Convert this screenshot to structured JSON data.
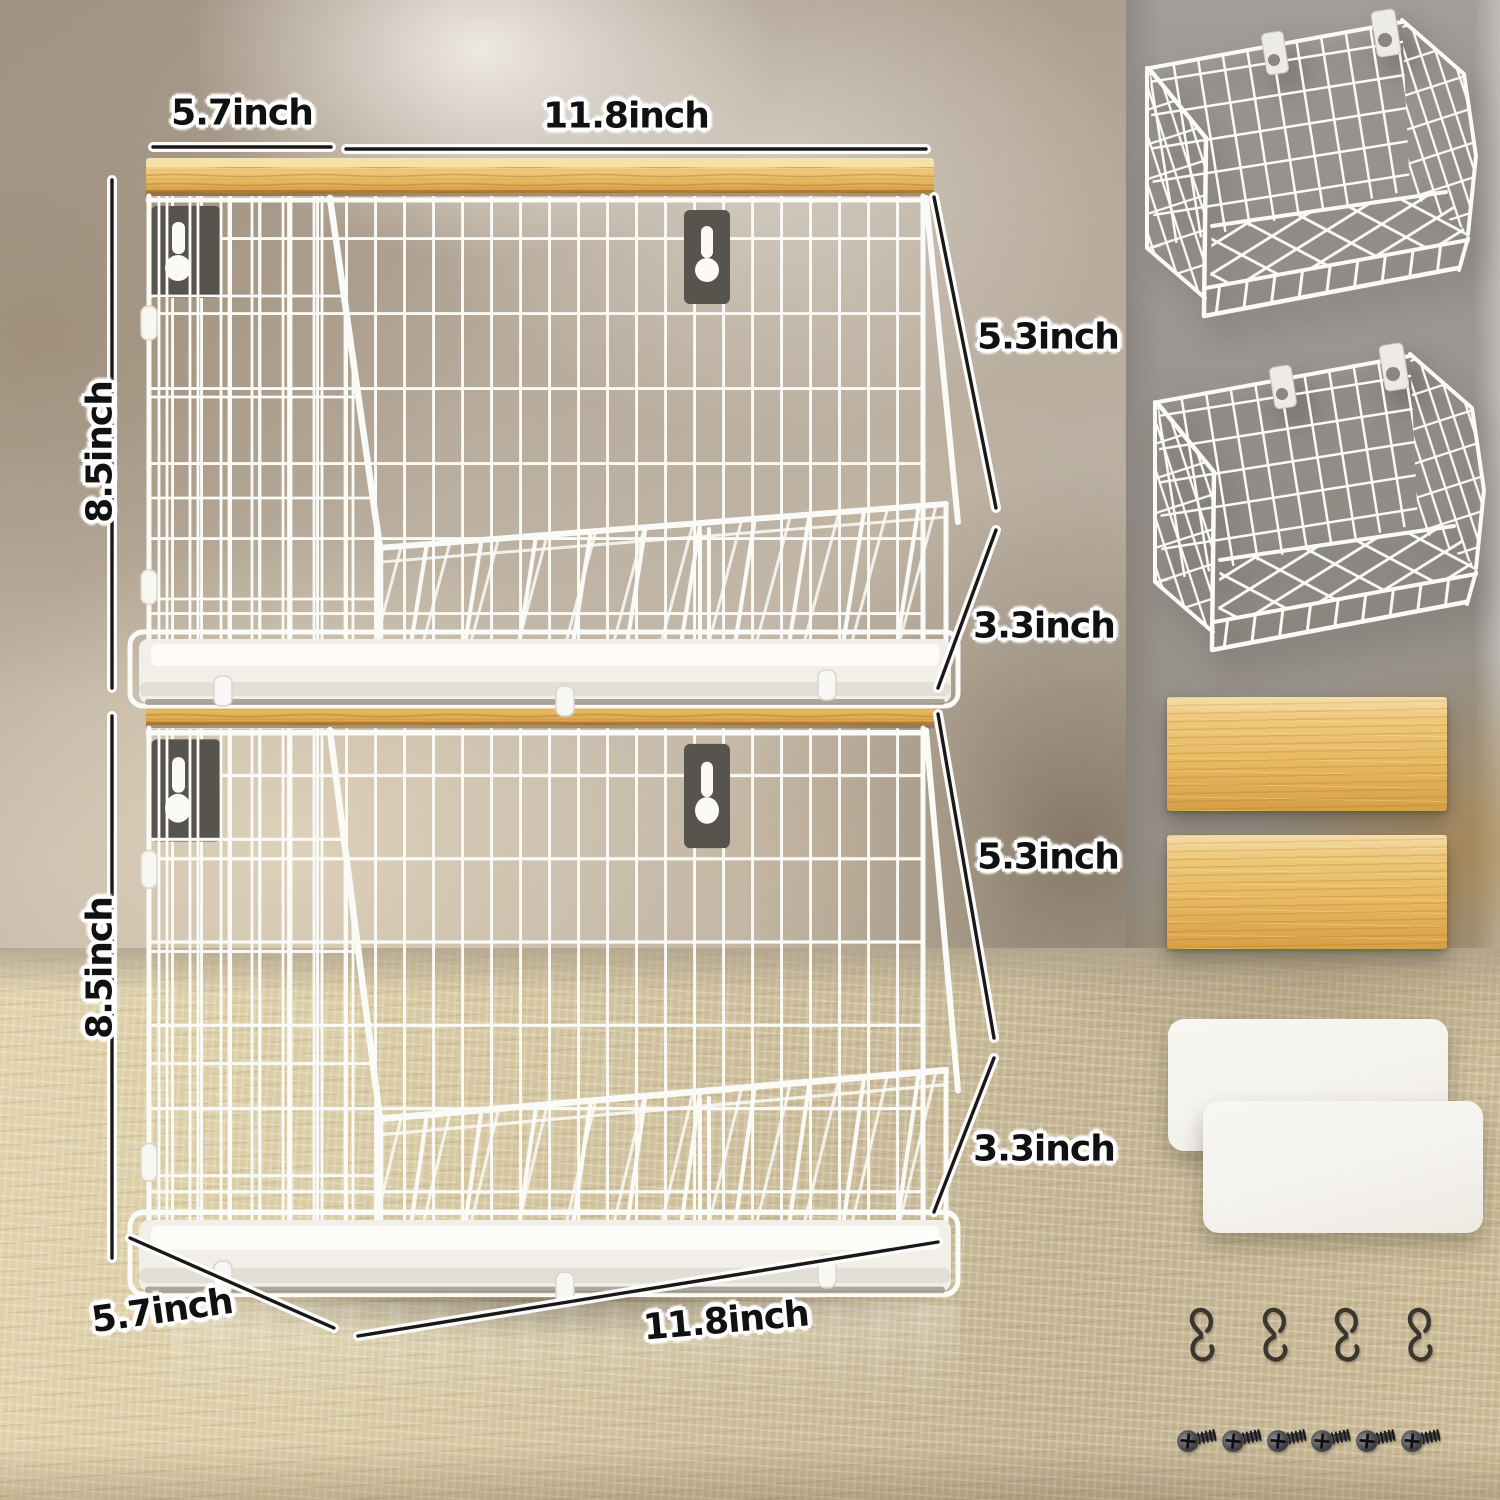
{
  "dimension_labels": {
    "top_depth": "5.7inch",
    "top_width": "11.8inch",
    "upper_basket_height": "8.5inch",
    "upper_basket_back_height": "5.3inch",
    "upper_basket_front_height": "3.3inch",
    "lower_basket_height": "8.5inch",
    "lower_basket_back_height": "5.3inch",
    "lower_basket_front_height": "3.3inch",
    "bottom_depth": "5.7inch",
    "bottom_width": "11.8inch"
  },
  "included_parts": {
    "wire_basket": {
      "icon": "wire-basket-icon",
      "count": 2
    },
    "wood_board": {
      "icon": "wood-board-icon",
      "count": 2
    },
    "bottom_mat": {
      "icon": "white-mat-icon",
      "count": 2
    },
    "s_hook": {
      "icon": "s-hook-icon",
      "count": 4
    },
    "screw": {
      "icon": "screw-icon",
      "count": 6
    }
  },
  "colors": {
    "wire_white": "#fafaf7",
    "wood_light": "#f2d088",
    "wood_mid": "#e7ba62",
    "wood_dark": "#d79f47",
    "plate_gray": "#57544e",
    "hook_black": "#3a372f",
    "screw_gray": "#454549",
    "label_ink": "#111111",
    "wall_gray": "#9a9591",
    "counter_tan": "#d5c7a2",
    "mat_white": "#f5f3ee"
  }
}
